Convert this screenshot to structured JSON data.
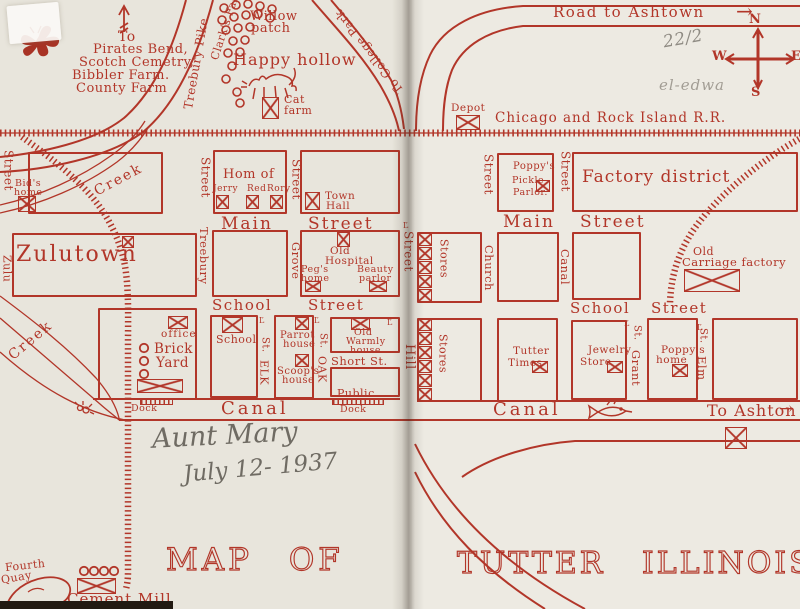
{
  "colors": {
    "ink": "#b23629",
    "paper_left": "#e8e5dc",
    "paper_right": "#edeae2",
    "pencil_dark": "#6f6b63",
    "pencil_light": "#938f86"
  },
  "decorations": {
    "lamp": "Ľ",
    "arrow_right": "→"
  },
  "top_left": {
    "to": "To",
    "destinations": [
      "Pirates Bend,",
      "Scotch Cemetry,",
      "Bibbler Farm.",
      "County Farm"
    ],
    "treebury_pike": "Treebury Pike",
    "clarks_falls": "Clark's Falls",
    "willow_1": "Willow",
    "willow_2": "patch",
    "happy_hollow": "Happy hollow",
    "cat_1": "Cat",
    "cat_2": "farm",
    "to_college_park": "To College Park"
  },
  "top_right": {
    "road_to_ashtown": "Road to Ashtown",
    "penciled_fraction": "22/2",
    "penciled_name": "el-edwa",
    "compass": {
      "n": "N",
      "e": "E",
      "s": "S",
      "w": "W"
    },
    "depot": "Depot",
    "railroad": "Chicago and Rock Island R.R."
  },
  "left_page": {
    "street_left": "Street",
    "bids_1": "Bid's",
    "bids_2": "home",
    "creek_upper": "Creek",
    "street_treebury": "Street",
    "hom_of": "Hom of",
    "jerry": "Jerry",
    "red": "Red",
    "rory": "Rory",
    "street_grove": "Street",
    "town_1": "Town",
    "town_2": "Hall",
    "main": "Main",
    "main_2": "Street",
    "zulu": "Zulu",
    "zulutown": "Zulutown",
    "treebury": "Treebury",
    "grove": "Grove",
    "hosp_1": "Old",
    "hosp_2": "Hospital",
    "pegs_1": "Peg's",
    "pegs_2": "home",
    "beauty_1": "Beauty",
    "beauty_2": "parlor",
    "school_st_1": "School",
    "school_st_2": "Street",
    "creek_lower": "Creek",
    "office": "office",
    "brick_1": "Brick",
    "brick_2": "Yard",
    "dock": "Dock",
    "school_house": "School",
    "st_abbr": "St.",
    "elk": "ELK",
    "oak": "OAK",
    "parrot_1": "Parrot",
    "parrot_2": "house",
    "scoop_1": "Scoop's",
    "scoop_2": "house",
    "warmly_1": "Old",
    "warmly_2": "Warmly",
    "warmly_3": "house",
    "short_st": "Short St.",
    "public_1": "Public",
    "public_2": "Dock",
    "canal": "Canal",
    "fourth_1": "Fourth",
    "fourth_2": "Quay",
    "cement_mill": "Cement Mill"
  },
  "right_page": {
    "street_ul": "Street",
    "poppy_1": "Poppy's",
    "poppy_2": "Pickle",
    "poppy_3": "Parlor.",
    "street_ur": "Street",
    "factory_district": "Factory district",
    "main": "Main",
    "main_2": "Street",
    "hill_st": "Street",
    "hill": "Hill",
    "stores_upper": "Stores",
    "stores_lower": "Stores",
    "church": "Church",
    "canal_street": "Canal",
    "carriage_1": "Old",
    "carriage_2": "Carriage factory",
    "school_st_1": "School",
    "school_st_2": "Street",
    "times_1": "Tutter",
    "times_2": "Times",
    "jewelry_1": "Jewelry",
    "jewelry_2": "Store",
    "st_abbr": "St.",
    "grant": "Grant",
    "elm": "Elm",
    "poppyhome_1": "Poppy's",
    "poppyhome_2": "home",
    "canal": "Canal",
    "to_ashton": "To Ashton"
  },
  "handwriting": {
    "name": "Aunt Mary",
    "date": "July 12- 1937"
  },
  "titles": {
    "map_of": "MAP OF",
    "tutter_illinois": "TUTTER ILLINOIS"
  }
}
